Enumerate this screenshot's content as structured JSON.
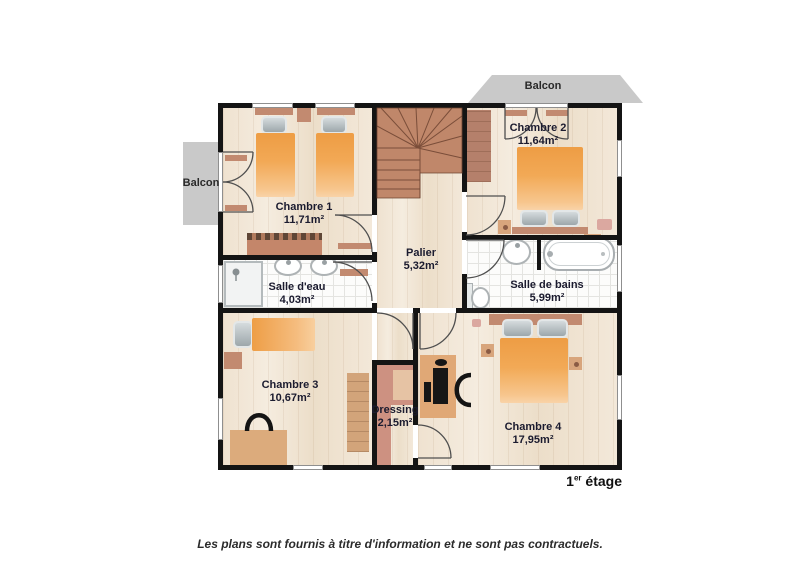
{
  "plan": {
    "title_floor": {
      "number": "1",
      "sup": "er",
      "name": "étage"
    },
    "caption": "Les plans sont fournis à titre d'information et ne sont pas contractuels.",
    "balcony_top": {
      "label": "Balcon"
    },
    "balcony_left": {
      "label": "Balcon"
    },
    "rooms": [
      {
        "id": "chambre-1",
        "name": "Chambre 1",
        "area": "11,71m²"
      },
      {
        "id": "chambre-2",
        "name": "Chambre 2",
        "area": "11,64m²"
      },
      {
        "id": "salle-deau",
        "name": "Salle d'eau",
        "area": "4,03m²"
      },
      {
        "id": "salle-de-bains",
        "name": "Salle de bains",
        "area": "5,99m²"
      },
      {
        "id": "palier",
        "name": "Palier",
        "area": "5,32m²"
      },
      {
        "id": "chambre-3",
        "name": "Chambre 3",
        "area": "10,67m²"
      },
      {
        "id": "dressing",
        "name": "Dressing",
        "area": "2,15m²"
      },
      {
        "id": "chambre-4",
        "name": "Chambre 4",
        "area": "17,95m²"
      }
    ],
    "colors": {
      "wall": "#141414",
      "bed_orange": "#ee9e46",
      "furniture_terracotta": "#c28a70",
      "stairs": "#c0876a",
      "balcony_gray": "#c9c9c9",
      "wood_floor": "#f0e4d3",
      "tile_floor": "#fcfcfb",
      "label_text": "#1b1b2f"
    }
  }
}
